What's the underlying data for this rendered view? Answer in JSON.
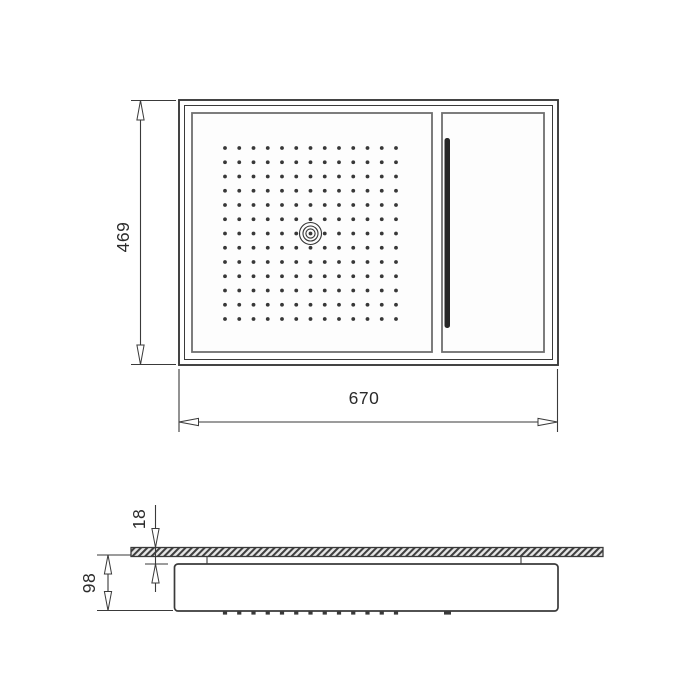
{
  "drawing": {
    "dimension_labels": {
      "overall_width": "670",
      "overall_depth": "469",
      "plate_thickness": "18",
      "body_height": "98"
    },
    "top_view": {
      "spray_grid": {
        "rows": 13,
        "cols": 13
      },
      "center_nozzle": "concentric-rings",
      "waterfall_slot": "vertical-slot"
    },
    "side_view": {
      "nozzle_ticks": 13,
      "ceiling_plate": "hatched-section"
    },
    "colors": {
      "line": "#3a3a3a",
      "panel_line": "#6f6f6f",
      "dot": "#383838",
      "slot": "#262626",
      "text": "#2b2b2b",
      "hatch_bg": "#e6e6e6"
    }
  }
}
